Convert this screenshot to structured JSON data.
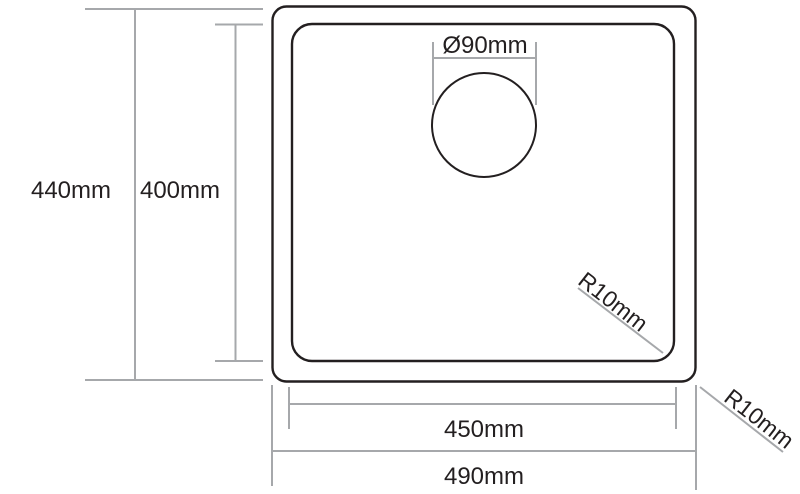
{
  "labels": {
    "overall_height": "440mm",
    "bowl_height": "400mm",
    "drain_diameter": "Ø90mm",
    "bowl_width": "450mm",
    "overall_width": "490mm",
    "bowl_corner_radius": "R10mm",
    "outer_corner_radius": "R10mm"
  },
  "colors": {
    "outline": "#231f20",
    "dimension": "#a6a8ab",
    "text": "#231f20",
    "background": "#ffffff"
  }
}
